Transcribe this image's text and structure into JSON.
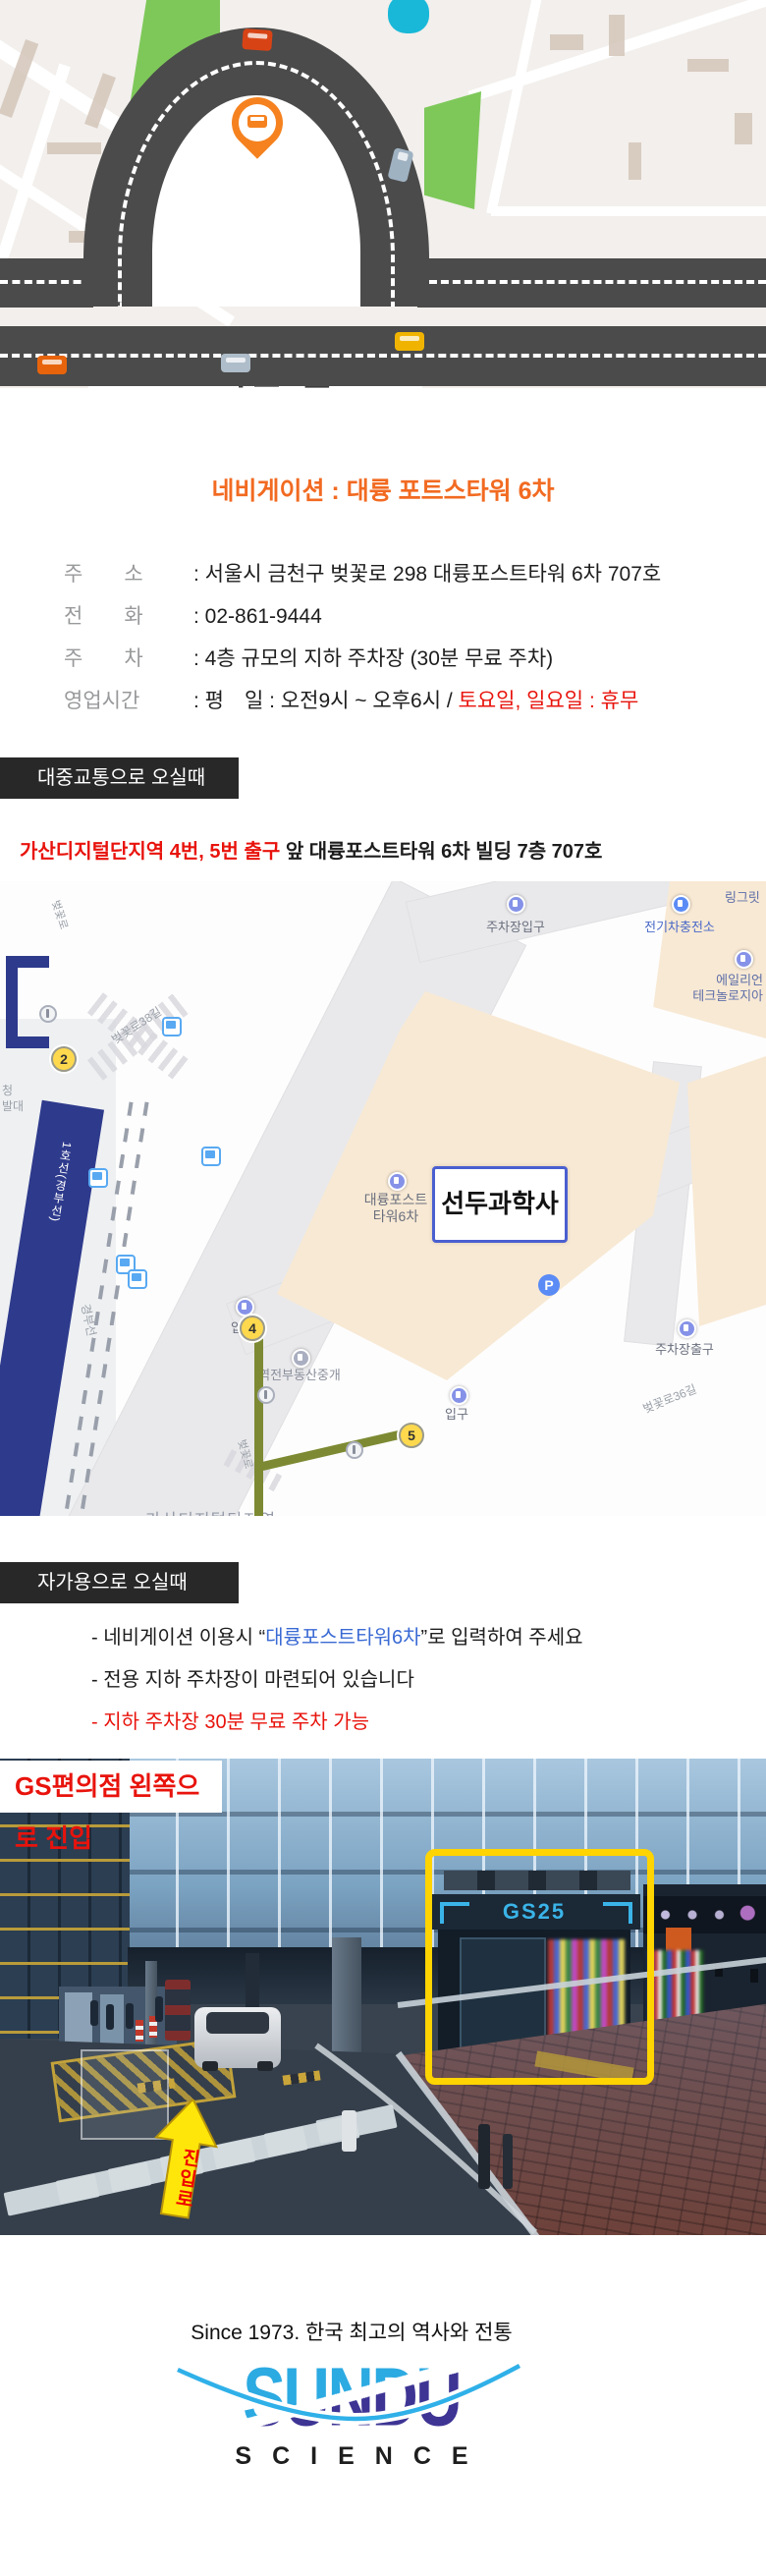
{
  "hero": {
    "title": "오시는 길"
  },
  "nav": {
    "title": "네비게이션 : 대륭 포트스타워 6차"
  },
  "info": {
    "rows": [
      {
        "label": "주　　소",
        "value": ": 서울시 금천구 벚꽃로 298 대륭포스트타워 6차 707호"
      },
      {
        "label": "전　　화",
        "value": ": 02-861-9444"
      },
      {
        "label": "주　　차",
        "value": ": 4층 규모의 지하 주차장 (30분 무료 주차)"
      },
      {
        "label": "영업시간",
        "value": ": 평　일 : 오전9시 ~ 오후6시 / ",
        "value_red": "토요일, 일요일 : 휴무"
      }
    ]
  },
  "transit": {
    "band": "대중교통으로 오실때",
    "highlight": "가산디지털단지역 4번, 5번 출구",
    "rest": " 앞 대륭포스트타워 6차 빌딩 7층 707호"
  },
  "map": {
    "company_box": "선두과학사",
    "building_line1": "대륭포스트",
    "building_line2": "타워6차",
    "parking_in": "주차장입구",
    "ev": "전기차충전소",
    "ring": "링그릿",
    "alien1": "에일리언",
    "alien2": "테크놀로지아",
    "entrance_left": "입구",
    "entrance_right": "입구",
    "parking_out": "주차장출구",
    "realty": "역전부동산중개",
    "st_38": "벚꽃로38길",
    "st_36": "벚꽃로36길",
    "st_cherry_top": "벚꽃로",
    "st_cherry_bottom": "벚꽃로",
    "rail": "경부선",
    "line1": "1호선(경부선)",
    "station_partial": "가산디지털단지역",
    "frag1": "청",
    "frag2": "발대",
    "m2": "2",
    "m4": "4",
    "m5": "5",
    "p": "P"
  },
  "car": {
    "band": "자가용으로 오실때",
    "b1_pre": "- 네비게이션 이용시 “",
    "b1_link": "대륭포스트타워6차",
    "b1_post": "”로 입력하여 주세요",
    "b2": "- 전용 지하 주차장이 마련되어 있습니다",
    "b3": "- 지하 주차장 30분 무료 주차 가능"
  },
  "gs": {
    "label": "GS편의점 왼쪽으로 진입",
    "sign": "GS25",
    "arrow": "진입로"
  },
  "footer": {
    "since": "Since 1973. 한국 최고의 역사와 전통",
    "logo": "SUNDU",
    "sub": "SCIENCE"
  },
  "colors": {
    "accent_orange": "#f26a21",
    "alert_red": "#e8130c",
    "link_blue": "#3a6ad4",
    "band_bg": "#282828",
    "map_navy": "#2e3a8c",
    "path_olive": "#7d8a33",
    "logo_cyan": "#2caae2",
    "logo_purple": "#3d3494",
    "highlight_yellow": "#ffd400"
  }
}
